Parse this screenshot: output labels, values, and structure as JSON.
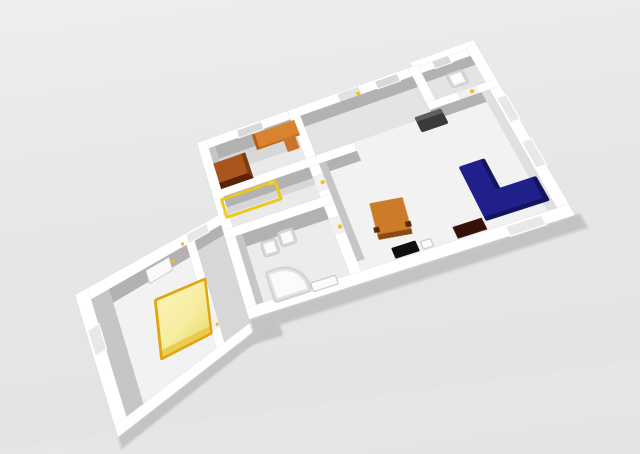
{
  "scene": {
    "viewport": "3d-home-floor-plan-aerial-view",
    "background": "#e6e6e6"
  },
  "palette": {
    "wall": "#ffffff",
    "floor": "#f2f2f2",
    "floor_light": "#eaeaea",
    "floor_mid": "#e4e4e4",
    "floor_gray": "#d7d7d7",
    "floor_bath": "#ececec",
    "inner_face": "#b2b2b2",
    "inner_face_light": "#c6c6c6",
    "right_wall_face": "#e0e0e0",
    "shadow": "#c3c3c3",
    "window_recess": "#d9d9d9",
    "window_recess_light": "#e8e8e8",
    "door_opening": "#e3e3e3",
    "handle_yellow": "#f0c020",
    "bed_double_yellow": "#f7efa4",
    "bed_frame_yellow": "#dfa60e",
    "bed_single_frame": "#ecc81e",
    "desk_orange": "#d9822f",
    "desk_side_orange": "#c97428",
    "cabinet_brown": "#a8561e",
    "cabinet_front_brown": "#5a2306",
    "table_orange": "#cc7c28",
    "table_front": "#8a4a12",
    "sofa_navy": "#20208c",
    "sofa_shade": "#14145e",
    "sideboard_maroon": "#38100a",
    "tv_black": "#0d0d0d",
    "armchair_gray": "#3a3a3a",
    "armchair_top_gray": "#5e5e5e",
    "fixture_white": "#fbfbfb",
    "fixture_outline": "#c6c6c6",
    "dresser_white": "#fafafa"
  },
  "furniture": [
    {
      "name": "cabinet",
      "color_key": "cabinet_brown"
    },
    {
      "name": "desk",
      "color_key": "desk_orange"
    },
    {
      "name": "single-bed",
      "color_key": "bed_single_frame"
    },
    {
      "name": "toilet",
      "color_key": "fixture_white"
    },
    {
      "name": "bidet",
      "color_key": "fixture_white"
    },
    {
      "name": "bathtub",
      "color_key": "fixture_white"
    },
    {
      "name": "wc-toilet",
      "color_key": "fixture_white"
    },
    {
      "name": "armchair",
      "color_key": "armchair_gray"
    },
    {
      "name": "square-table",
      "color_key": "table_orange"
    },
    {
      "name": "corner-sofa",
      "color_key": "sofa_navy"
    },
    {
      "name": "sideboard",
      "color_key": "sideboard_maroon"
    },
    {
      "name": "tv",
      "color_key": "tv_black"
    },
    {
      "name": "double-bed",
      "color_key": "bed_double_yellow"
    },
    {
      "name": "dresser",
      "color_key": "dresser_white"
    }
  ]
}
